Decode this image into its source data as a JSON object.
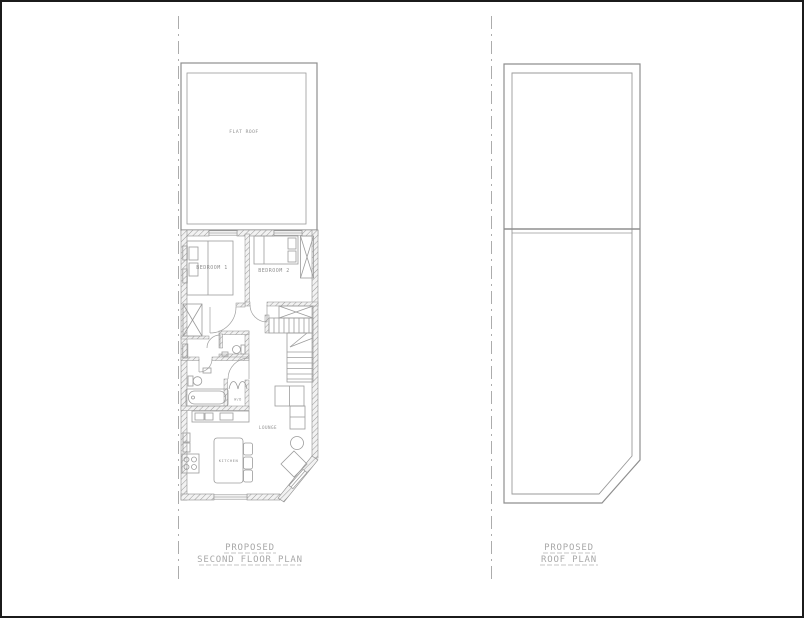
{
  "colors": {
    "line": "#8c8c8c",
    "wall": "#8f8f8f",
    "window_line": "#9a9a9a",
    "title_text": "#a8a8a8",
    "room_text": "#8a8a8a",
    "border": "#1b1b1b"
  },
  "floor_plan": {
    "title_line1": "PROPOSED",
    "title_line2": "SECOND FLOOR PLAN",
    "labels": {
      "flat_roof": "FLAT ROOF",
      "bedroom1": "BEDROOM 1",
      "bedroom2": "BEDROOM 2",
      "lounge": "LOUNGE",
      "kitchen": "KITCHEN",
      "washer_dryer": "W/D"
    }
  },
  "roof_plan": {
    "title_line1": "PROPOSED",
    "title_line2": "ROOF PLAN"
  }
}
